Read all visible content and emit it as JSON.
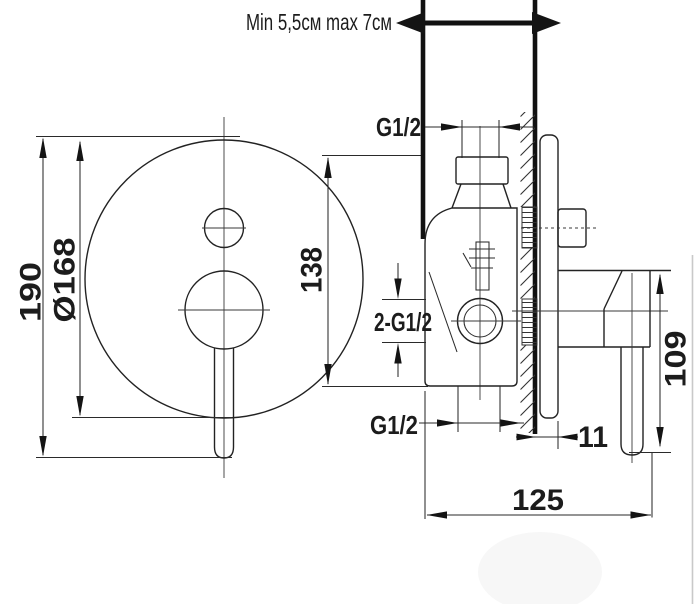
{
  "drawing": {
    "colors": {
      "ink": "#1f1f1f",
      "paper": "#ffffff",
      "edge_artifact": "#c9c9c9"
    },
    "annotations": {
      "wall_range": "Min 5,5см max 7см",
      "top_thread": "G1/2",
      "side_threads": "2-G1/2",
      "bottom_thread": "G1/2"
    },
    "dimensions": {
      "front_height": "190",
      "plate_diameter": "Ø168",
      "ports_span": "138",
      "handle_length": "109",
      "plate_offset": "11",
      "total_depth": "125"
    }
  }
}
